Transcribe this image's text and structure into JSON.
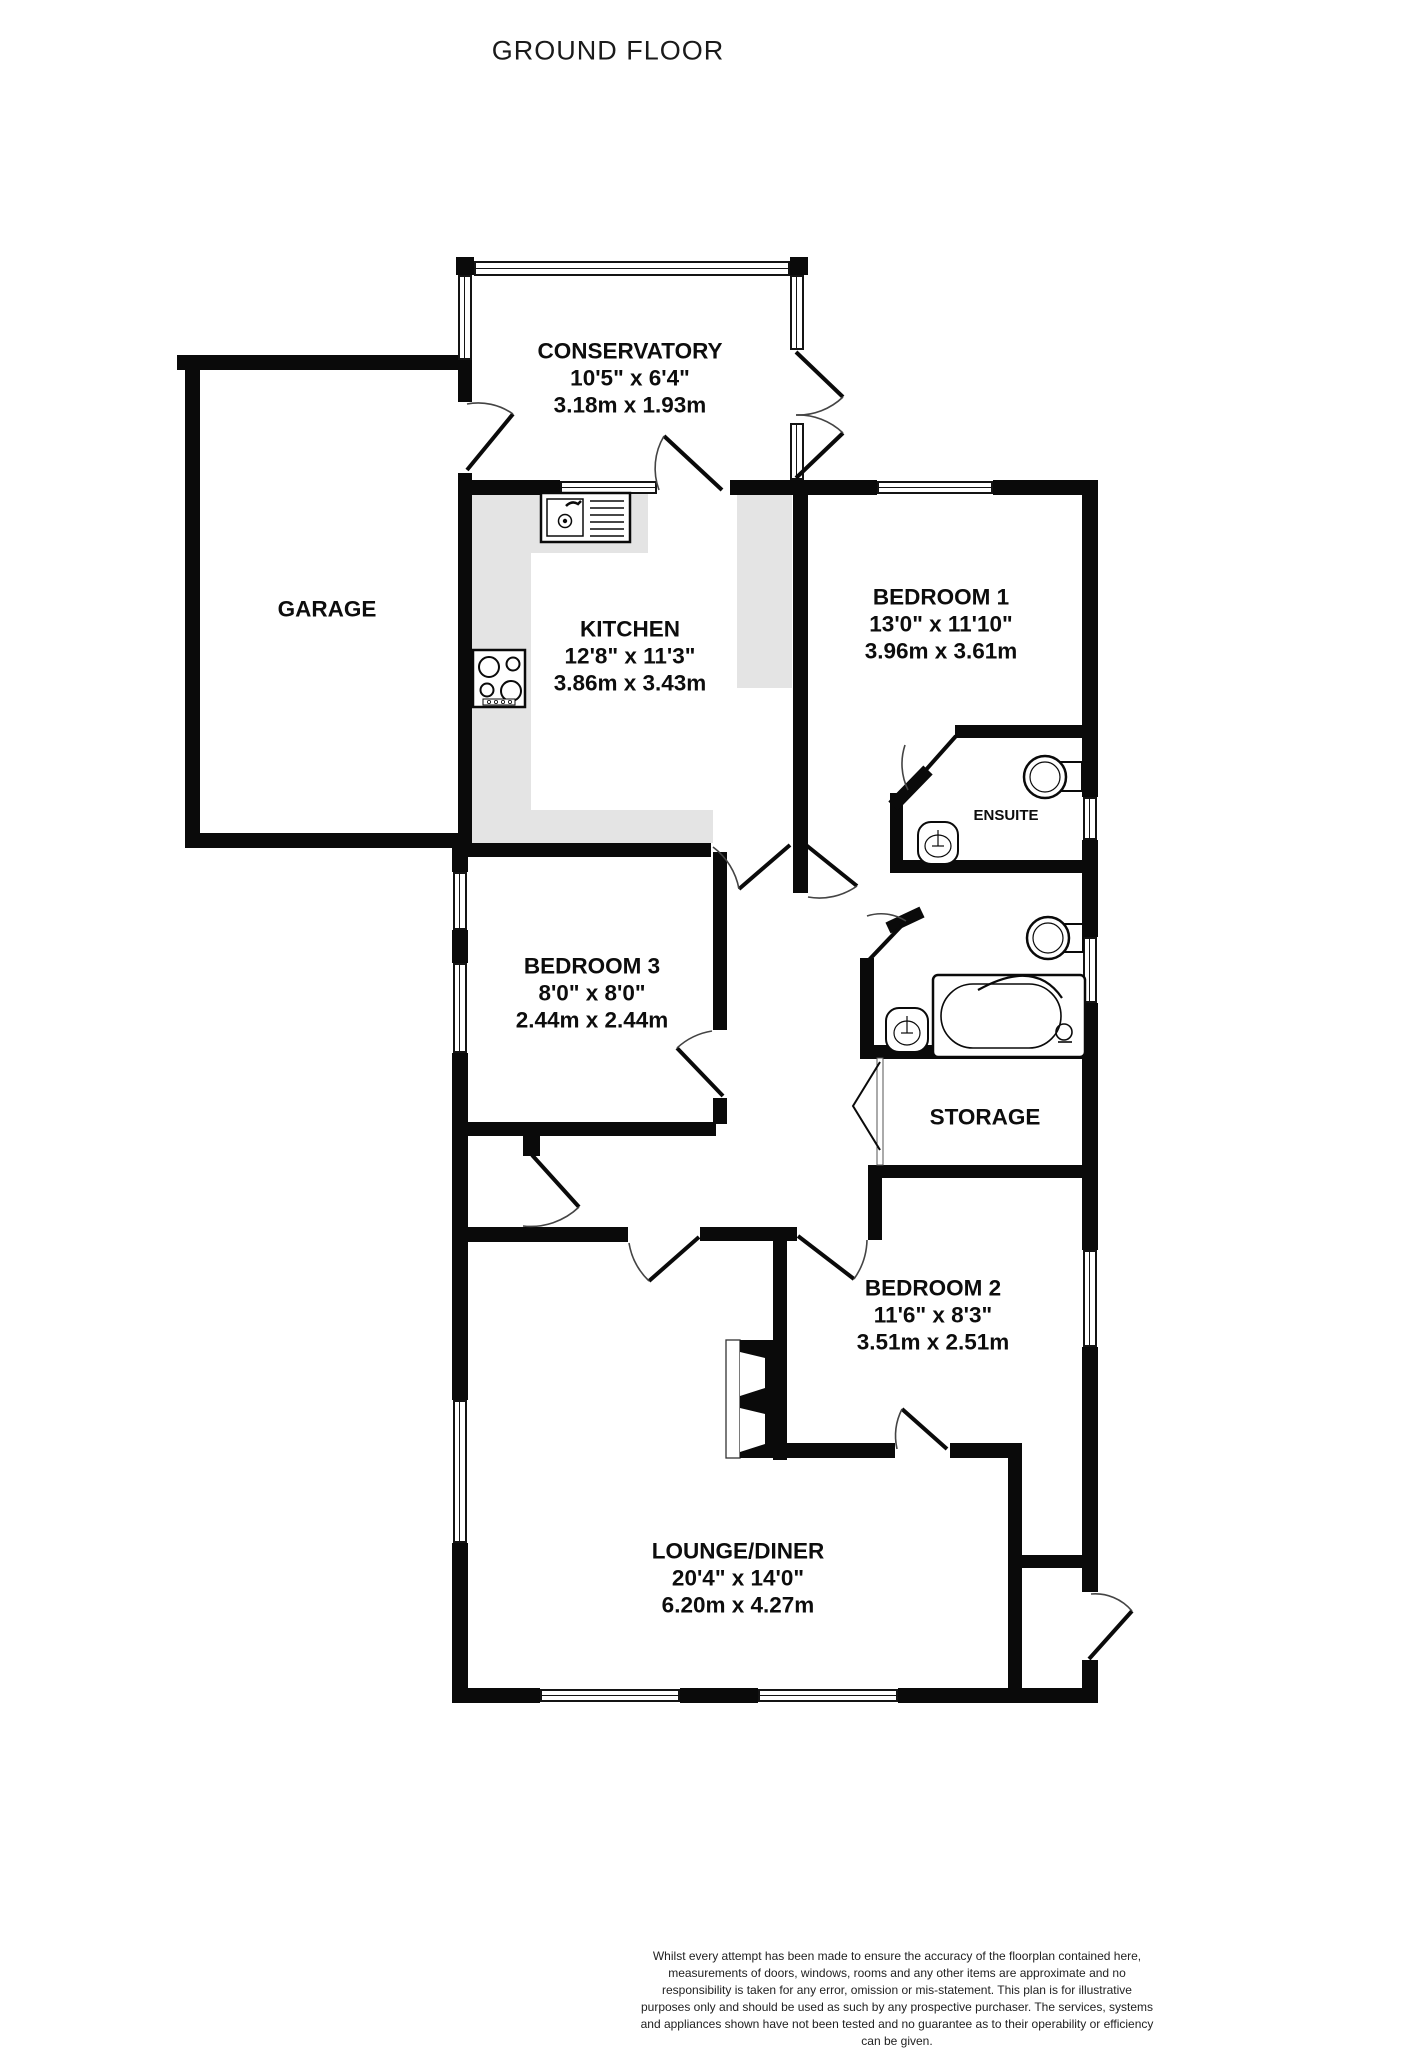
{
  "title": "GROUND FLOOR",
  "rooms": {
    "conservatory": {
      "name": "CONSERVATORY",
      "imperial": "10'5\" x 6'4\"",
      "metric": "3.18m x 1.93m"
    },
    "garage": {
      "name": "GARAGE"
    },
    "kitchen": {
      "name": "KITCHEN",
      "imperial": "12'8\" x 11'3\"",
      "metric": "3.86m x 3.43m"
    },
    "bedroom1": {
      "name": "BEDROOM 1",
      "imperial": "13'0\" x 11'10\"",
      "metric": "3.96m x 3.61m"
    },
    "ensuite": {
      "name": "ENSUITE"
    },
    "bedroom3": {
      "name": "BEDROOM 3",
      "imperial": "8'0\" x 8'0\"",
      "metric": "2.44m x 2.44m"
    },
    "storage": {
      "name": "STORAGE"
    },
    "bedroom2": {
      "name": "BEDROOM 2",
      "imperial": "11'6\" x 8'3\"",
      "metric": "3.51m x 2.51m"
    },
    "lounge": {
      "name": "LOUNGE/DINER",
      "imperial": "20'4\" x 14'0\"",
      "metric": "6.20m x 4.27m"
    }
  },
  "footer": {
    "disclaimer": "Whilst every attempt has been made to ensure the accuracy of the floorplan contained here, measurements of doors, windows, rooms and any other items are approximate and no responsibility is taken for any error, omission or mis-statement. This plan is for illustrative purposes only and should be used as such by any prospective purchaser. The services, systems and appliances shown have not been tested and no guarantee as to their operability or efficiency can be given.",
    "credit": "Made with Metropix ©2025"
  },
  "colors": {
    "wall": "#0a0a0a",
    "counter": "#e4e4e4",
    "text": "#111111"
  }
}
